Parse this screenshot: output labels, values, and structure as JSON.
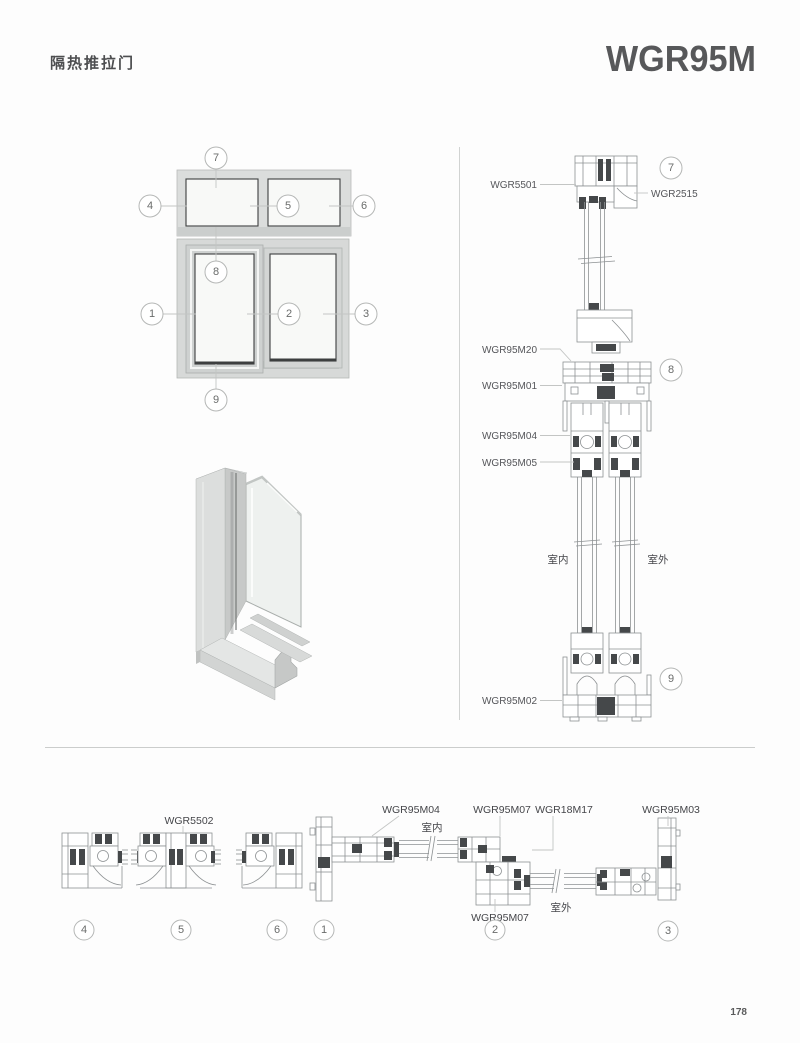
{
  "header": {
    "title": "隔热推拉门",
    "model": "WGR95M"
  },
  "footer": {
    "page_number": "178"
  },
  "callouts": {
    "c1": "1",
    "c2": "2",
    "c3": "3",
    "c4": "4",
    "c5": "5",
    "c6": "6",
    "c7": "7",
    "c8": "8",
    "c9": "9"
  },
  "vertical_section": {
    "sash_head": "WGR5501",
    "frame_head": "WGR2515",
    "sash_bottom": "WGR95M20",
    "track_top": "WGR95M01",
    "sash_top_rail": "WGR95M04",
    "glazing_bead": "WGR95M05",
    "track_bottom": "WGR95M02",
    "indoor": "室内",
    "outdoor": "室外"
  },
  "horizontal_section": {
    "transom_mullion": "WGR5502",
    "frame_side": "WGR95M04",
    "interlock_a": "WGR95M07",
    "insert": "WGR18M17",
    "jamb": "WGR95M03",
    "interlock_b": "WGR95M07",
    "indoor": "室内",
    "outdoor": "室外"
  },
  "colors": {
    "line": "#8d9193",
    "dark_fill": "#45484a",
    "leader": "#c3c5c4",
    "text": "#55565a"
  }
}
